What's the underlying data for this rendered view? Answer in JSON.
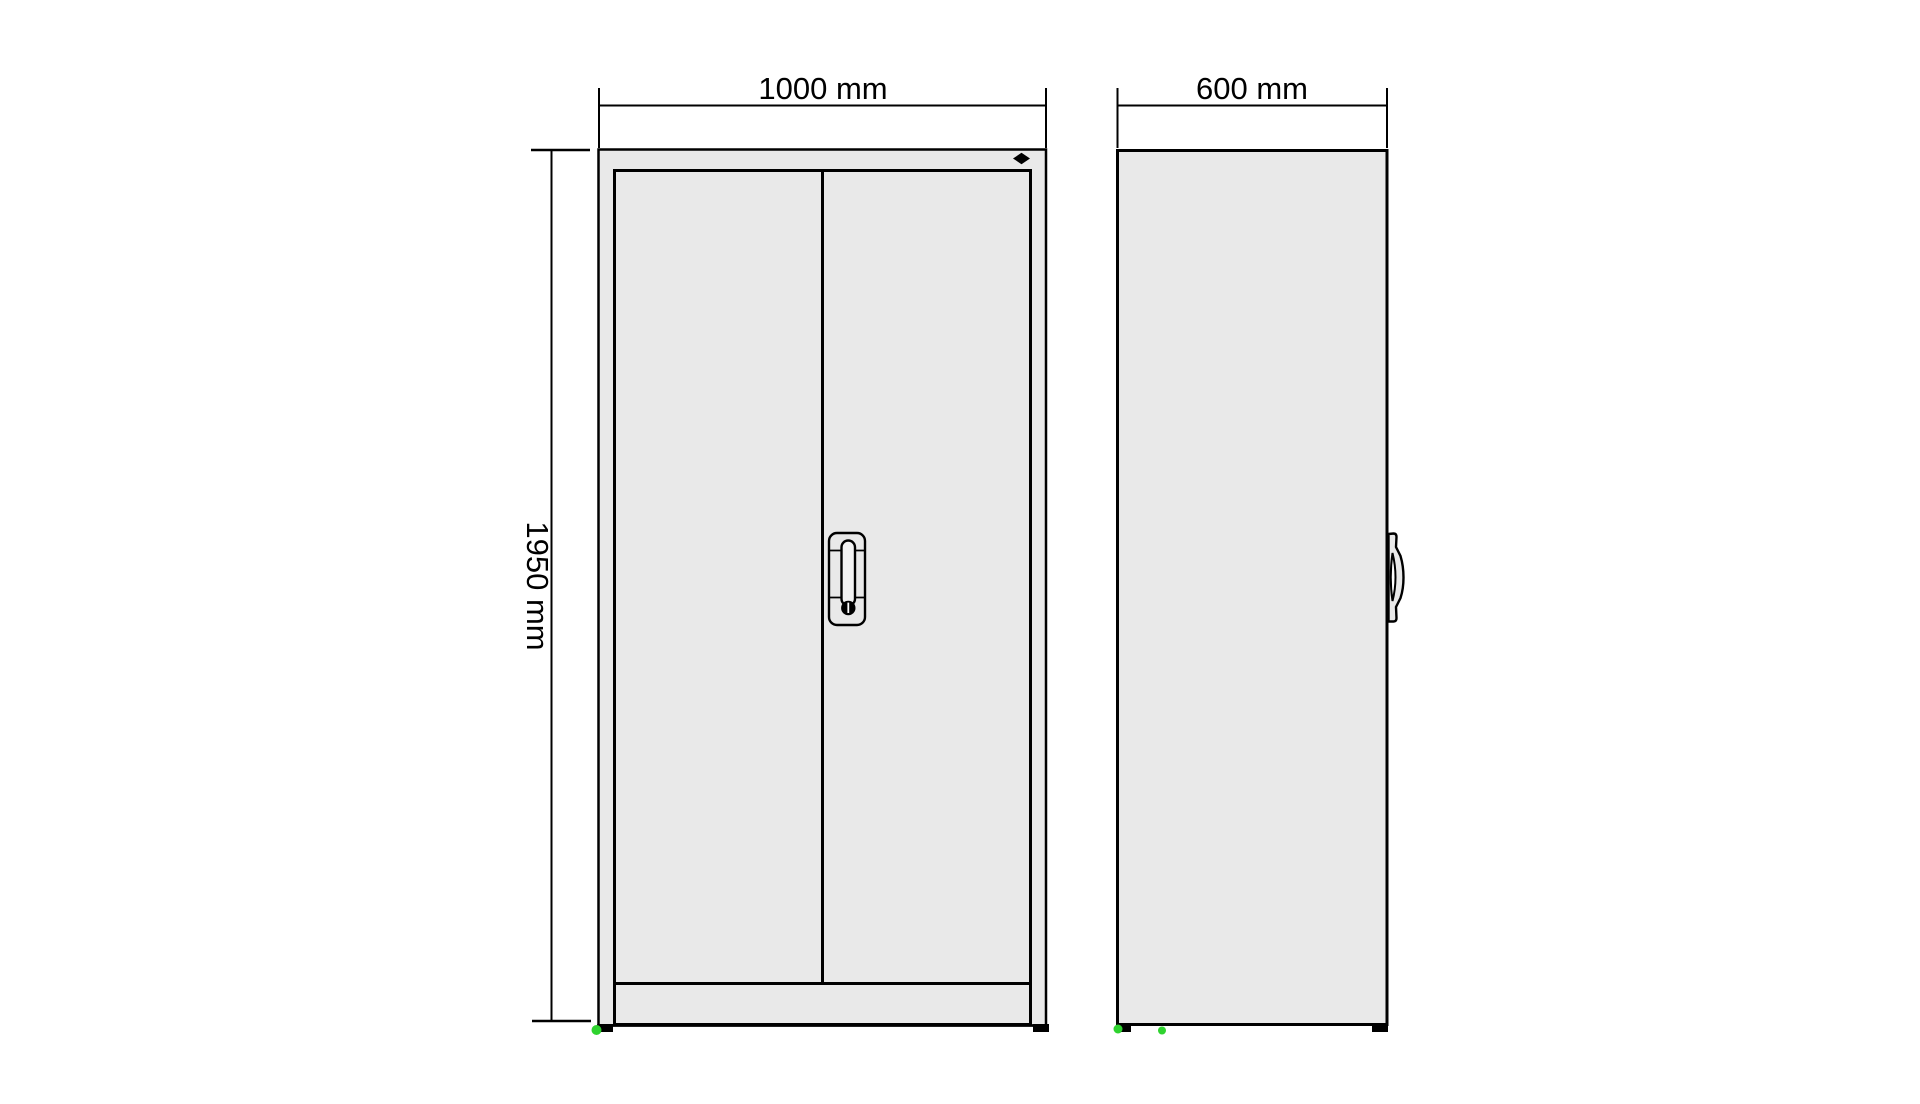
{
  "view": {
    "front": {
      "width_dimension": "1000 mm",
      "height_dimension": "1950 mm"
    },
    "side": {
      "depth_dimension": "600 mm"
    }
  },
  "markers": {
    "top_rail_marker": "black-diamond",
    "foot_markers": "green-dots"
  },
  "colors": {
    "background": "#ffffff",
    "line": "#000000",
    "panel_fill": "#e9e9e9",
    "handle_fill": "#f2f2f2",
    "foot_dot_green": "#2fd32f"
  }
}
